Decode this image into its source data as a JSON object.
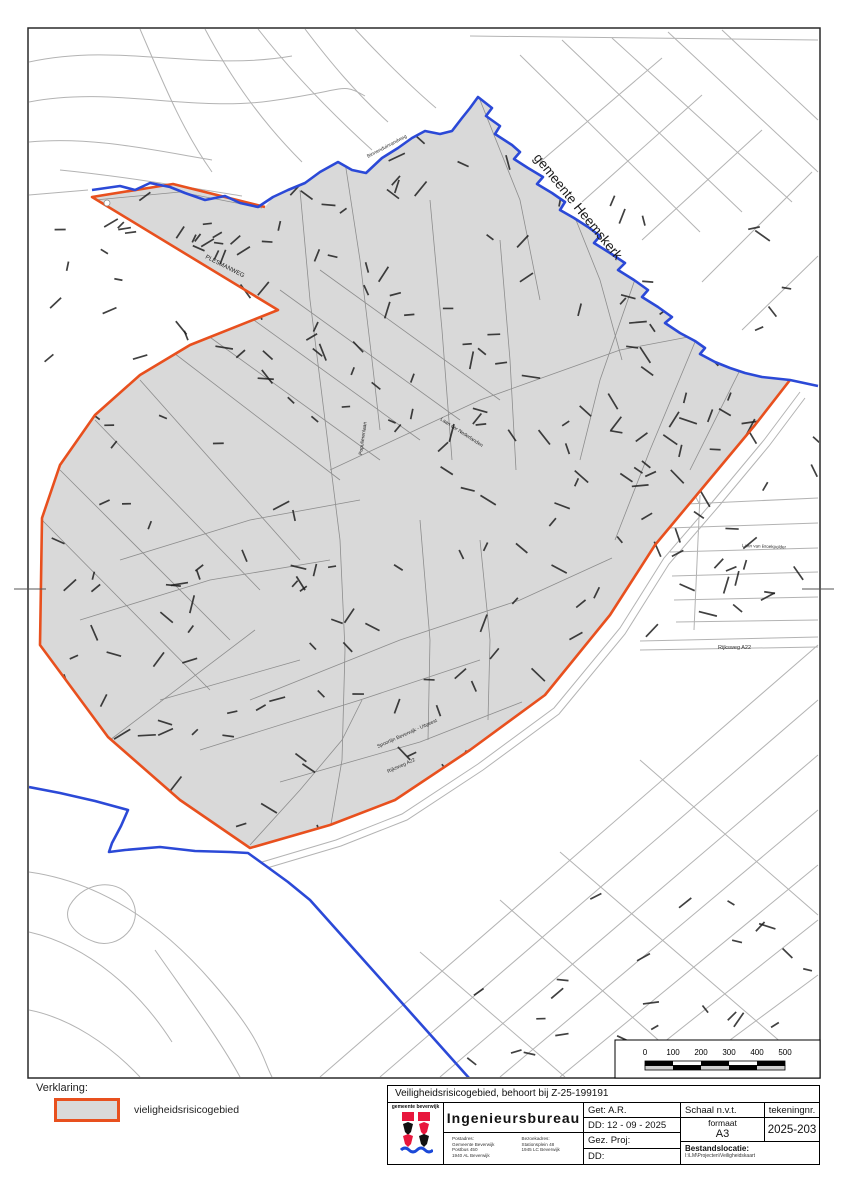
{
  "map": {
    "region_label": "gemeente Heemskerk",
    "labels": [
      {
        "text": "gemeente Heemskerk",
        "x": 533,
        "y": 158,
        "rot": 51,
        "size": 13.5,
        "color": "#1a1a1a"
      },
      {
        "text": "PLESMANWEG",
        "x": 205,
        "y": 258,
        "rot": 27,
        "size": 6,
        "color": "#222"
      },
      {
        "text": "Binnenduinrandweg",
        "x": 368,
        "y": 158,
        "rot": -28,
        "size": 5,
        "color": "#333"
      },
      {
        "text": "Spoorlijn Beverwijk - Uitgeest",
        "x": 378,
        "y": 748,
        "rot": -24,
        "size": 5,
        "color": "#333"
      },
      {
        "text": "Rijksweg A22",
        "x": 388,
        "y": 773,
        "rot": -24,
        "size": 5,
        "color": "#333"
      },
      {
        "text": "Rijksweg A22",
        "x": 718,
        "y": 649,
        "rot": 0,
        "size": 5.5,
        "color": "#333"
      },
      {
        "text": "Laan van Broekpolder",
        "x": 742,
        "y": 547,
        "rot": 2,
        "size": 4.5,
        "color": "#333"
      },
      {
        "text": "Populierenlaan",
        "x": 362,
        "y": 455,
        "rot": -82,
        "size": 5,
        "color": "#222"
      },
      {
        "text": "Laan der Nederlanden",
        "x": 440,
        "y": 420,
        "rot": 33,
        "size": 5,
        "color": "#222"
      }
    ],
    "colors": {
      "risk_fill": "#d9d9d9",
      "risk_border": "#e8501e",
      "municipal_boundary": "#2b49d7",
      "street_outer": "#b3b3b3",
      "street_inner": "#8d8d8d"
    }
  },
  "legend": {
    "heading": "Verklaring:",
    "item_label": "vieligheidsrisicogebied"
  },
  "scalebar": {
    "ticks": [
      "0",
      "100",
      "200",
      "300",
      "400",
      "500"
    ]
  },
  "titleblock": {
    "sheet_title": "Veiligheidsrisicogebied, behoort bij Z-25-199191",
    "org_logo_text": "gemeente beverwijk",
    "bureau": "Ingenieursbureau",
    "postadres": {
      "heading": "Postadres:",
      "lines": [
        "Gemeente Beverwijk",
        "Postbus 450",
        "1940 AL  Beverwijk"
      ]
    },
    "bezoekadres": {
      "heading": "Bezoekadres:",
      "lines": [
        "Stationsplein 48",
        "1945 LC  Beverwijk"
      ]
    },
    "get": "Get: A.R.",
    "dd1": "DD: 12 - 09 - 2025",
    "gez": "Gez. Proj:",
    "dd2": "DD:",
    "schaal": "Schaal n.v.t.",
    "formaat_label": "formaat",
    "formaat_value": "A3",
    "tekeningnr_label": "tekeningnr.",
    "tekeningnr_value": "2025-203",
    "bestandslocatie_label": "Bestandslocatie:",
    "bestandslocatie_value": "I:\\LM\\Projecten\\Veiligheidskaart"
  }
}
